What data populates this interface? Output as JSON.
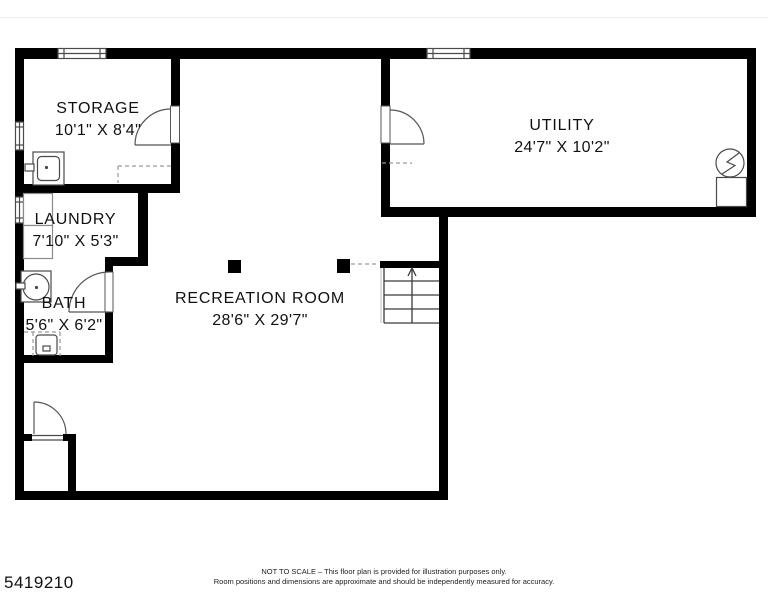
{
  "plan": {
    "rooms": {
      "storage": {
        "name": "STORAGE",
        "dims": "10'1\" X 8'4\""
      },
      "laundry": {
        "name": "LAUNDRY",
        "dims": "7'10\" X 5'3\""
      },
      "bath": {
        "name": "BATH",
        "dims": "5'6\" X 6'2\""
      },
      "recreation": {
        "name": "RECREATION ROOM",
        "dims": "28'6\" X 29'7\""
      },
      "utility": {
        "name": "UTILITY",
        "dims": "24'7\" X 10'2\""
      }
    },
    "fixtures": [
      "utility-sink",
      "washer-dryer-stack",
      "round-sink",
      "toilet",
      "water-heater-lightning-circle",
      "furnace-box",
      "stairs-up-arrow",
      "support-column",
      "support-column"
    ],
    "colors": {
      "wall": "#000000",
      "fixture_line": "#4a4a4a",
      "appliance_line": "#8a8a8a",
      "dashed_line": "#9a9a9a",
      "text": "#111111",
      "background": "#ffffff"
    }
  },
  "footer": {
    "mls_number": "5419210",
    "disclaimer_line1": "NOT TO SCALE – This floor plan is provided for illustration purposes only.",
    "disclaimer_line2": "Room positions and dimensions are approximate and should be independently measured for accuracy."
  }
}
